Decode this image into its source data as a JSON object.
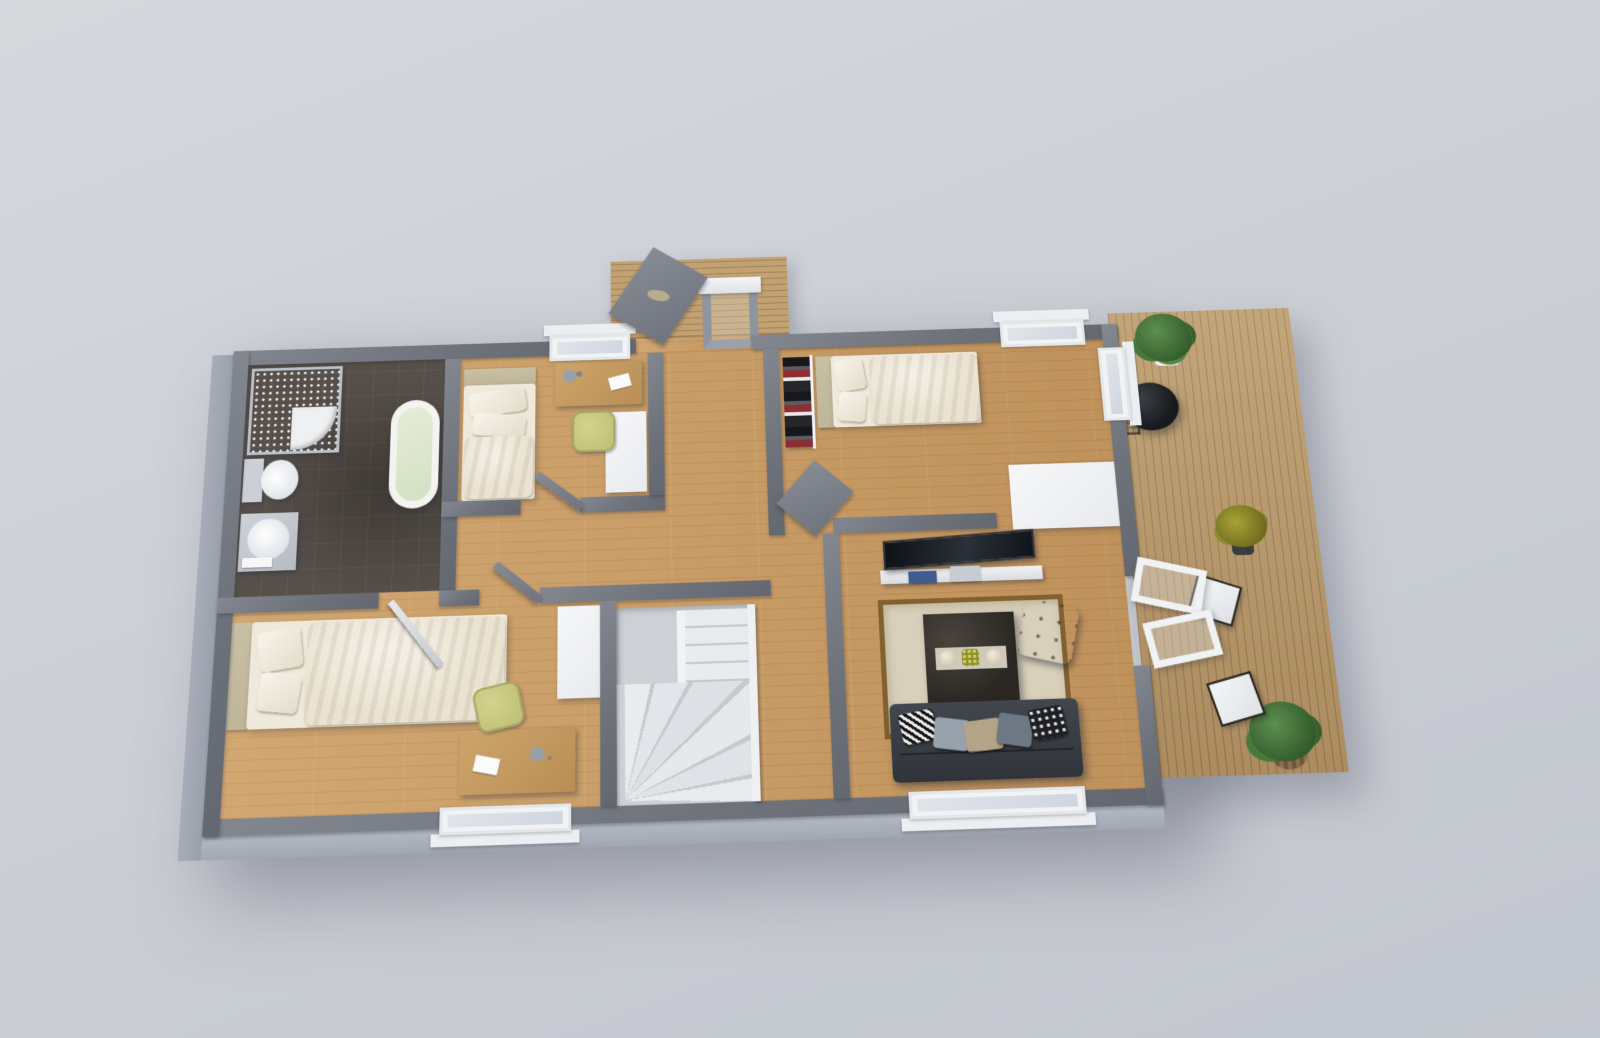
{
  "scene": {
    "title": "3D apartment floor plan — top-down architectural render",
    "style": "photoreal 3D visualization, no text labels",
    "background": "#cdd0d6"
  },
  "colors": {
    "wall": "#6e727a",
    "wallLight": "#83878f",
    "wallFace": "#a8aeb9",
    "wood": "#c89a63",
    "deckWood": "#b9996b",
    "tile": "#57504a",
    "headboard": "#bfb69a",
    "bedLinen": "#efe9db",
    "olive": "#bdbe74",
    "sofa": "#3a3f46",
    "rug": "#d9d0bb",
    "rugBorder": "#82612e",
    "stair": "#e9ebee",
    "plant": "#47793b",
    "grill": "#17191d"
  },
  "rooms": [
    {
      "name": "Bathroom",
      "floor": "dark tile",
      "items": [
        "corner glass shower",
        "freestanding bathtub",
        "toilet",
        "sink vanity with towel"
      ]
    },
    {
      "name": "Bedroom 1",
      "floor": "wood",
      "items": [
        "single bed",
        "desk with lamp and paper",
        "olive desk chair",
        "white wardrobe"
      ]
    },
    {
      "name": "Entrance Hall",
      "floor": "wood",
      "items": [
        "open front door to porch"
      ]
    },
    {
      "name": "Bedroom 2",
      "floor": "wood",
      "items": [
        "single bed",
        "open clothes rack",
        "white dresser"
      ]
    },
    {
      "name": "Living Room",
      "floor": "wood",
      "items": [
        "tv on media stand",
        "bordered rug",
        "dark coffee table with tray",
        "tufted ottoman",
        "charcoal sofa with cushions"
      ]
    },
    {
      "name": "Bedroom 3",
      "floor": "wood",
      "items": [
        "single bed",
        "desk with lamp and paper",
        "olive desk chair",
        "white wardrobe"
      ]
    },
    {
      "name": "Staircase",
      "floor": "stair treads",
      "items": [
        "winder staircase with white railing"
      ]
    },
    {
      "name": "Hallway",
      "floor": "wood",
      "items": []
    }
  ],
  "outdoor": {
    "porch": {
      "name": "Entrance Porch",
      "items": [
        "wood decking",
        "open front door",
        "porch door frame"
      ]
    },
    "deck": {
      "name": "Side Deck",
      "items": [
        "potted green plant",
        "kettle grill",
        "wire basket",
        "olive plant in dark pot",
        "open double glass door",
        "two outdoor chairs",
        "plant in woven planter"
      ]
    }
  }
}
